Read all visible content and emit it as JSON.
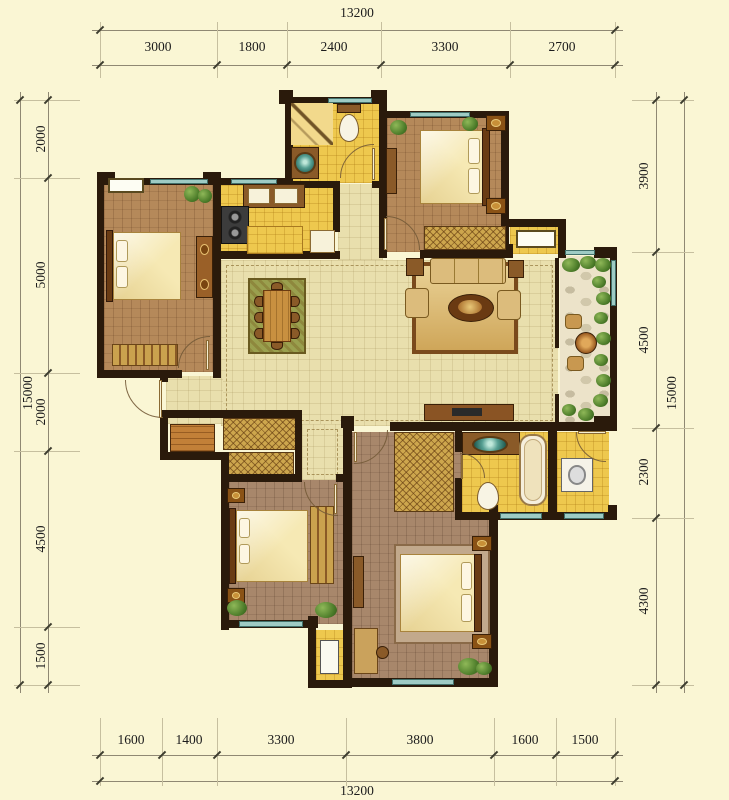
{
  "title": "apartment-floor-plan",
  "palette": {
    "background": "#faf6d4",
    "wall": "#2a1a0b",
    "wood_floor": "#b5895a",
    "wood_floor_dark": "#a8876b",
    "tile_yellow": "#eec84e",
    "tile_beige": "#e9dfad",
    "balcony_stone": "#ece3c9",
    "window_glass": "#9ecbc4",
    "plant_green": "#4a7a28",
    "furniture_brown": "#8a5a28",
    "bed_linen": "#f6e9b4",
    "dim_text": "#1c1c1c"
  },
  "dimensions": {
    "top": {
      "total": "13200",
      "segments": [
        "3000",
        "1800",
        "2400",
        "3300",
        "2700"
      ]
    },
    "bottom": {
      "total": "13200",
      "segments": [
        "1600",
        "1400",
        "3300",
        "3800",
        "1600",
        "1500"
      ]
    },
    "left": {
      "total": "15000",
      "segments": [
        "2000",
        "5000",
        "2000",
        "4500",
        "1500"
      ]
    },
    "right": {
      "total": "15000",
      "segments": [
        "3900",
        "4500",
        "2300",
        "4300"
      ]
    }
  }
}
